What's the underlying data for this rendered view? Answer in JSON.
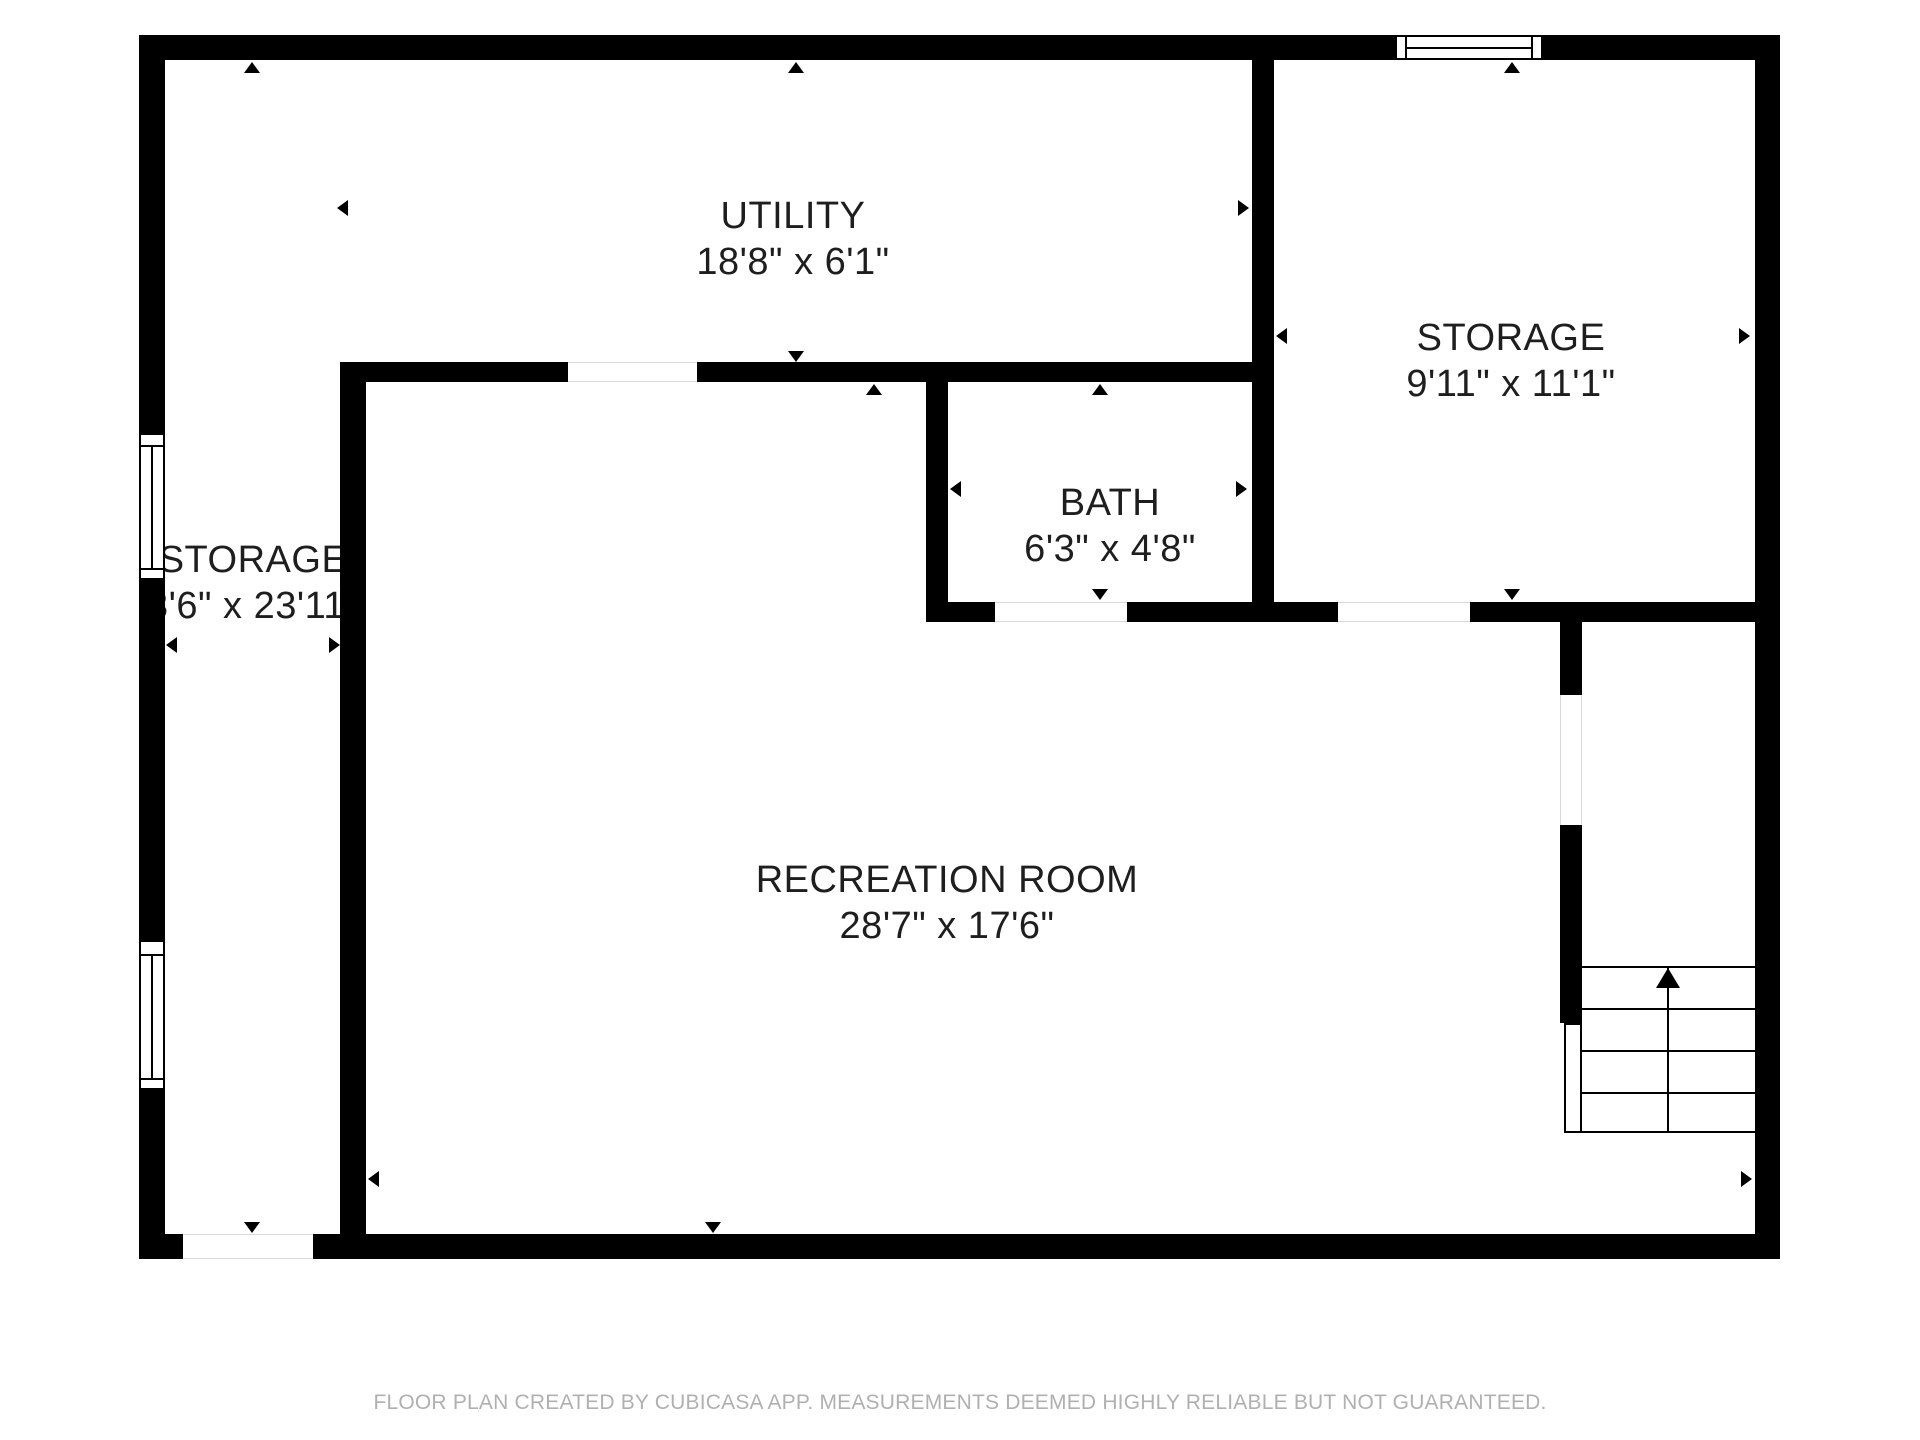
{
  "plan": {
    "rooms": {
      "utility": {
        "label": "UTILITY",
        "dimensions": "18'8\" x 6'1\""
      },
      "storage_left": {
        "label": "STORAGE",
        "dimensions": "3'6\" x 23'11\""
      },
      "storage_right": {
        "label": "STORAGE",
        "dimensions": "9'11\" x 11'1\""
      },
      "bath": {
        "label": "BATH",
        "dimensions": "6'3\" x 4'8\""
      },
      "recreation": {
        "label": "RECREATION ROOM",
        "dimensions": "28'7\" x 17'6\""
      }
    },
    "stairs": {
      "direction": "up"
    },
    "footer_disclaimer": "FLOOR PLAN CREATED BY CUBICASA APP. MEASUREMENTS DEEMED HIGHLY RELIABLE BUT NOT GUARANTEED.",
    "colors": {
      "wall": "#000000",
      "room_text": "#1e1e1e",
      "footer_text": "#b0b0b0",
      "background": "#ffffff"
    }
  }
}
